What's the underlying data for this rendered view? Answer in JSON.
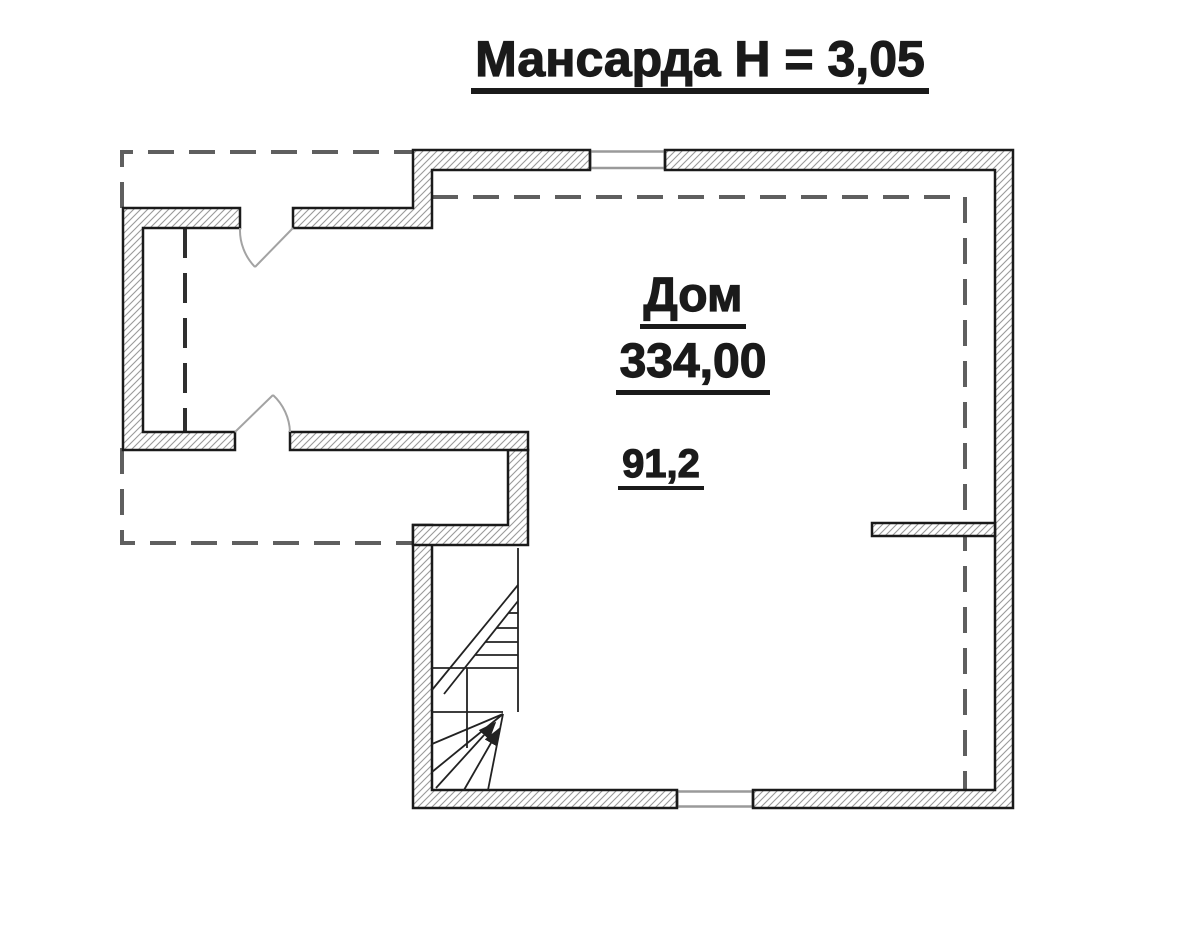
{
  "title": "Мансарда Н = 3,05",
  "labels": {
    "room_name": "Дом",
    "room_area": "334,00",
    "area_note": "91,2"
  },
  "plan_elements": {
    "rooms": [
      "Дом"
    ],
    "features": [
      "staircase",
      "door-upper",
      "door-lower",
      "window-north",
      "window-south",
      "roof-edge-dashed-lines"
    ]
  },
  "colors": {
    "ink": "#1a1a1a",
    "hatch": "#9a9a9a",
    "dashed": "#5f5f5f",
    "door": "#a3a3a3",
    "background": "#ffffff"
  }
}
